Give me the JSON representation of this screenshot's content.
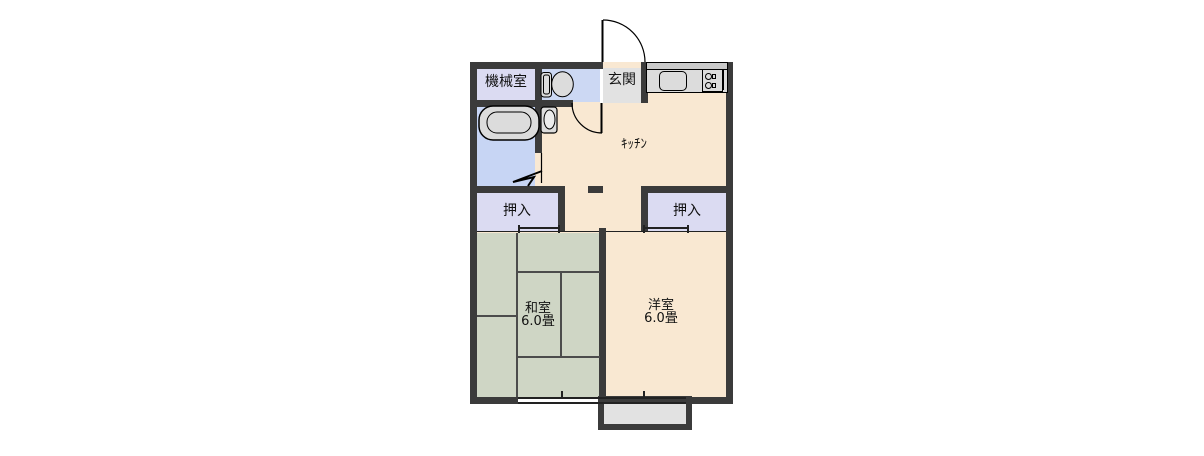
{
  "floorplan": {
    "rooms": {
      "machine_room": {
        "label": "機械室"
      },
      "genkan": {
        "label": "玄関"
      },
      "kitchen": {
        "label": "ｷｯﾁﾝ"
      },
      "closet_left": {
        "label": "押入"
      },
      "closet_right": {
        "label": "押入"
      },
      "washitsu": {
        "label": "和室",
        "size": "6.0畳"
      },
      "youshitsu": {
        "label": "洋室",
        "size": "6.0畳"
      }
    },
    "fixtures": [
      "bathtub-icon",
      "toilet-icon",
      "wash-basin-icon",
      "kitchen-sink-icon",
      "stove-icon",
      "entrance-door-arc",
      "kitchen-door-arc",
      "folding-door-mark",
      "sliding-door-marks",
      "window-marks"
    ],
    "colors": {
      "wall": "#3b3b3b",
      "cream": "#f9e8d2",
      "lavender": "#dbdbf2",
      "toilet_blue": "#ccd8f3",
      "bath_blue": "#c7d5f4",
      "gray": "#e2e2e2",
      "tatami_green": "#cfd6c5",
      "fixture_gray": "#dcdcdc",
      "line": "#222222"
    }
  }
}
